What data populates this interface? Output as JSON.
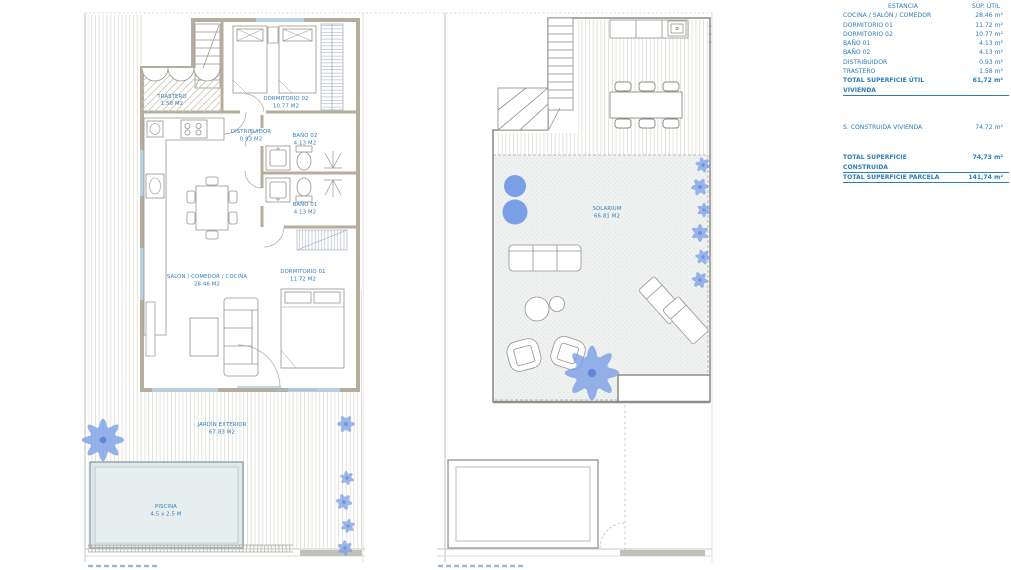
{
  "table": {
    "header": {
      "estancia": "ESTANCIA",
      "sup_util": "SUP. ÚTIL"
    },
    "rows": [
      {
        "label": "COCINA / SALÓN / COMEDOR",
        "value": "28.46 m²"
      },
      {
        "label": "DORMITORIO 01",
        "value": "11.72 m²"
      },
      {
        "label": "DORMITORIO 02",
        "value": "10.77 m²"
      },
      {
        "label": "BAÑO 01",
        "value": "4.13 m²"
      },
      {
        "label": "BAÑO 02",
        "value": "4.13 m²"
      },
      {
        "label": "DISTRIBUIDOR",
        "value": "0.93 m²"
      },
      {
        "label": "TRASTERO",
        "value": "1.58 m²"
      }
    ],
    "total_util": {
      "label": "TOTAL SUPERFICIE ÚTIL VIVIENDA",
      "value": "61,72 m²"
    },
    "construida": {
      "label": "S. CONSTRUIDA VIVIENDA",
      "value": "74.72 m²"
    },
    "total_construida": {
      "label": "TOTAL SUPERFICIE CONSTRUIDA",
      "value": "74,73 m²"
    },
    "total_parcela": {
      "label": "TOTAL SUPERFICIE PARCELA",
      "value": "141,74 m²"
    }
  },
  "plan_labels": {
    "trastero": {
      "name": "TRASTERO",
      "area": "1.58 M2"
    },
    "dormitorio02": {
      "name": "DORMITORIO 02",
      "area": "10.77 M2"
    },
    "distribuidor": {
      "name": "DISTRIBUIDOR",
      "area": "0.93 M2"
    },
    "bano02": {
      "name": "BAÑO 02",
      "area": "4.13 M2"
    },
    "bano01": {
      "name": "BAÑO 01",
      "area": "4.13 M2"
    },
    "salon": {
      "name": "SALÓN / COMEDOR / COCINA",
      "area": "28.46 M2"
    },
    "dormitorio01": {
      "name": "DORMITORIO 01",
      "area": "11.72 M2"
    },
    "jardin": {
      "name": "JARDÍN EXTERIOR",
      "area": "67.83 M2"
    },
    "piscina": {
      "name": "PISCINA",
      "area": "4.5 x 2.5 M"
    },
    "solarium": {
      "name": "SOLARIUM",
      "area": "66.81 M2"
    }
  },
  "colors": {
    "accent_blue": "#2e7cb8",
    "plant_blue": "#7b9fe6",
    "wall_tan": "#b5ae9e",
    "pool_fill": "#dfe9ea"
  }
}
